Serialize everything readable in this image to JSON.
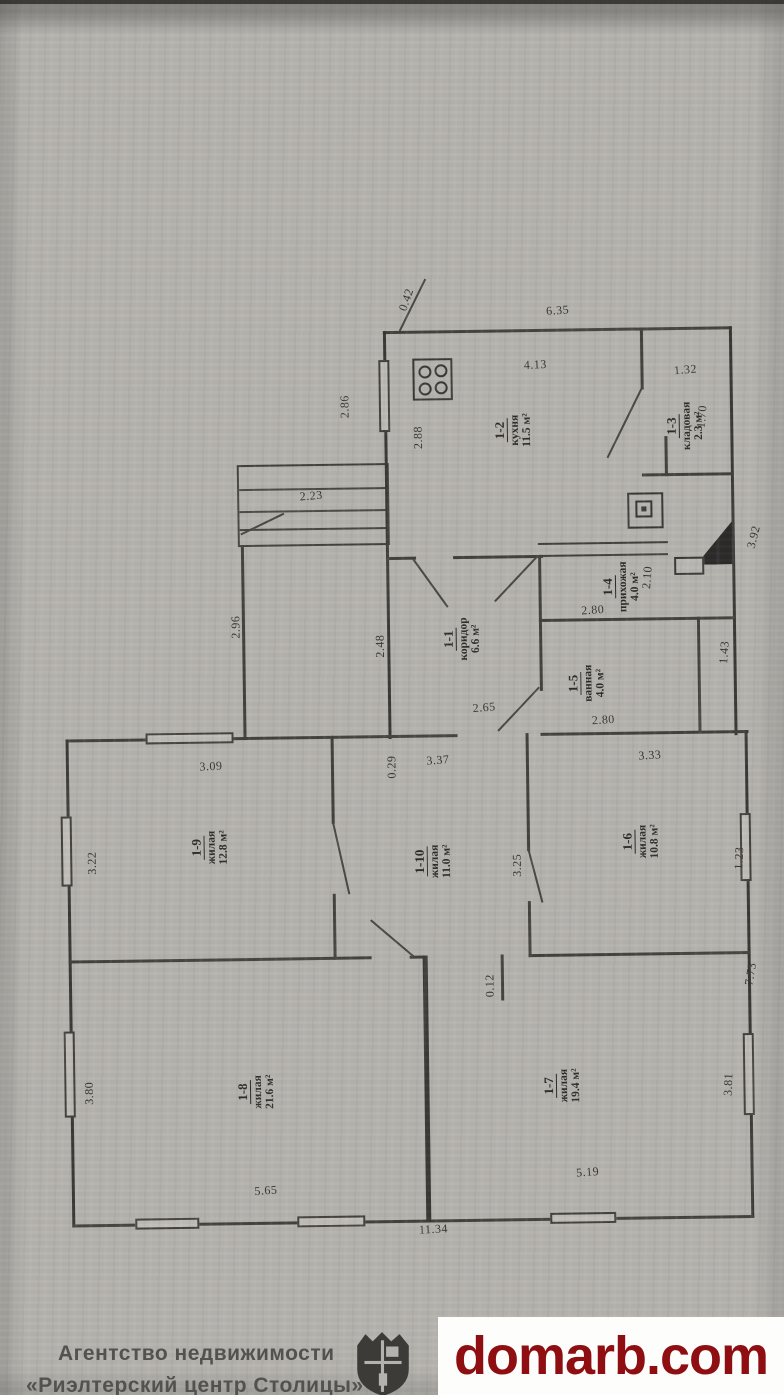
{
  "plan": {
    "rooms": [
      {
        "num": "1-1",
        "name": "коридор",
        "area": "6.6 м²",
        "x": 462,
        "y": 640
      },
      {
        "num": "1-2",
        "name": "кухня",
        "area": "11.5 м²",
        "x": 516,
        "y": 432
      },
      {
        "num": "1-3",
        "name": "кладовая",
        "area": "2.3 м²",
        "x": 688,
        "y": 430
      },
      {
        "num": "1-4",
        "name": "прихожая",
        "area": "4.0 м²",
        "x": 622,
        "y": 590
      },
      {
        "num": "1-5",
        "name": "ванная",
        "area": "4.0 м²",
        "x": 586,
        "y": 686
      },
      {
        "num": "1-6",
        "name": "жилая",
        "area": "10.8 м²",
        "x": 638,
        "y": 845
      },
      {
        "num": "1-7",
        "name": "жилая",
        "area": "19.4 м²",
        "x": 556,
        "y": 1088
      },
      {
        "num": "1-8",
        "name": "жилая",
        "area": "21.6 м²",
        "x": 250,
        "y": 1090
      },
      {
        "num": "1-9",
        "name": "жилая",
        "area": "12.8 м²",
        "x": 207,
        "y": 845
      },
      {
        "num": "1-10",
        "name": "жилая",
        "area": "11.0 м²",
        "x": 430,
        "y": 862
      }
    ],
    "dims": [
      {
        "t": "0.42",
        "x": 412,
        "y": 300,
        "r": -70
      },
      {
        "t": "6.35",
        "x": 563,
        "y": 313,
        "r": -3
      },
      {
        "t": "4.13",
        "x": 540,
        "y": 367,
        "r": -2
      },
      {
        "t": "1.32",
        "x": 690,
        "y": 374,
        "r": -4
      },
      {
        "t": "2.86",
        "x": 349,
        "y": 406,
        "r": -90
      },
      {
        "t": "2.88",
        "x": 422,
        "y": 438,
        "r": -90
      },
      {
        "t": "1.70",
        "x": 706,
        "y": 421,
        "r": -85
      },
      {
        "t": "2.23",
        "x": 314,
        "y": 495,
        "r": -4
      },
      {
        "t": "2.96",
        "x": 237,
        "y": 625,
        "r": -90
      },
      {
        "t": "2.48",
        "x": 381,
        "y": 646,
        "r": -90
      },
      {
        "t": "2.10",
        "x": 649,
        "y": 581,
        "r": -85
      },
      {
        "t": "2.80",
        "x": 594,
        "y": 613,
        "r": -3
      },
      {
        "t": "1.43",
        "x": 725,
        "y": 657,
        "r": -85
      },
      {
        "t": "2.65",
        "x": 484,
        "y": 709,
        "r": -4
      },
      {
        "t": "2.80",
        "x": 603,
        "y": 723,
        "r": -3
      },
      {
        "t": "3.92",
        "x": 756,
        "y": 542,
        "r": -75
      },
      {
        "t": "3.09",
        "x": 210,
        "y": 764,
        "r": -2
      },
      {
        "t": "0.29",
        "x": 391,
        "y": 767,
        "r": -90
      },
      {
        "t": "3.37",
        "x": 437,
        "y": 761,
        "r": -3
      },
      {
        "t": "3.33",
        "x": 649,
        "y": 759,
        "r": -3
      },
      {
        "t": "3.22",
        "x": 90,
        "y": 859,
        "r": -90
      },
      {
        "t": "3.25",
        "x": 515,
        "y": 867,
        "r": -90
      },
      {
        "t": "1.23",
        "x": 737,
        "y": 863,
        "r": -87
      },
      {
        "t": "0.12",
        "x": 486,
        "y": 987,
        "r": -90
      },
      {
        "t": "7.73",
        "x": 747,
        "y": 979,
        "r": -80
      },
      {
        "t": "3.80",
        "x": 84,
        "y": 1089,
        "r": -90
      },
      {
        "t": "3.81",
        "x": 723,
        "y": 1089,
        "r": -87
      },
      {
        "t": "5.65",
        "x": 259,
        "y": 1189,
        "r": -3
      },
      {
        "t": "5.19",
        "x": 581,
        "y": 1175,
        "r": -3
      },
      {
        "t": "11.34",
        "x": 426,
        "y": 1230,
        "r": -2
      }
    ]
  },
  "footer": {
    "agency_line1": "Агентство недвижимости",
    "agency_line2": "«Риэлтерский центр Столицы»",
    "watermark": "domarb.com",
    "watermark_color": "#8e0e12"
  }
}
